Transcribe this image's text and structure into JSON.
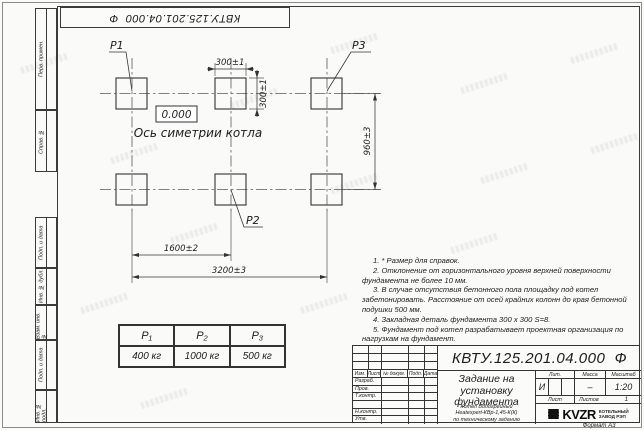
{
  "frame": {
    "designation_top": "КВТУ.125.201.04.000  Ф",
    "format_label": "Формат А3",
    "left_strip_top": [
      "Перв. примен.",
      "Справ. №"
    ],
    "left_strip_bottom": [
      "Подп. и дата",
      "Инв. № дубл.",
      "Взам. инв. №",
      "Подп. и дата",
      "Инв. № подл."
    ]
  },
  "drawing": {
    "p1": "P1",
    "p2": "P2",
    "p3": "P3",
    "elevation": "0.000",
    "axis_label": "Ось симетрии котла",
    "dim_width": "300±1",
    "dim_height": "300±1",
    "dim_row_spacing": "960±3",
    "dim_col_spacing": "1600±2",
    "dim_total": "3200±3"
  },
  "notes": {
    "items": [
      "1. * Размер для справок.",
      "2. Отклонение от горизонтального уровня верхней поверхности фундамента не более 10 мм.",
      "3. В случае отсутствия бетонного пола площадку под котел забетонировать. Расстояние от осей крайних колонн до края бетонной подушки 500 мм.",
      "4. Закладная деталь фундамента 300 х 300 S=8.",
      "5. Фундамент под котел разрабатывает проектная организация по нагрузкам на фундамент."
    ]
  },
  "load_table": {
    "headers": [
      "P₁",
      "P₂",
      "P₃"
    ],
    "values": [
      "400 кг",
      "1000 кг",
      "500 кг"
    ]
  },
  "title_block": {
    "designation": "КВТУ.125.201.04.000  Ф",
    "doc_title": "Задание на установку фундамента",
    "subtitle": [
      "Котел Водогрейный",
      "Heatexpert-КВр-1,45-К(К)",
      "по техническому заданию"
    ],
    "change_cols": [
      "Изм.",
      "Лист",
      "№ докум.",
      "Подп.",
      "Дата"
    ],
    "sig_rows": [
      "Разраб.",
      "Пров.",
      "Т.контр.",
      "Н.контр.",
      "Утв."
    ],
    "lit_label": "Лит.",
    "lit_value": "И",
    "mass_label": "Масса",
    "mass_value": "–",
    "scale_label": "Масштаб",
    "scale_value": "1:20",
    "sheet_label": "Лист",
    "sheets_label": "Листов",
    "sheets_value": "1",
    "logo": "KVZR",
    "company": [
      "КОТЕЛЬНЫЙ",
      "ЗАВОД РЭП"
    ]
  }
}
